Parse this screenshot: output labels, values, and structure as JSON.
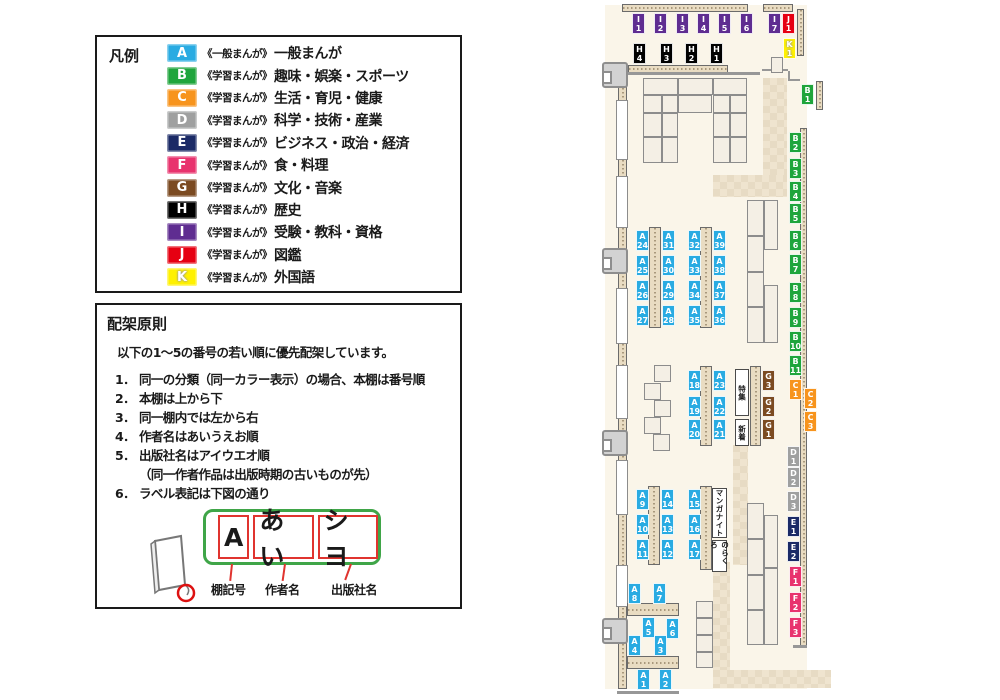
{
  "legend": {
    "title": "凡例",
    "items": [
      {
        "code": "A",
        "color": "#29abe2",
        "prefix": "《一般まんが》",
        "label": "一般まんが"
      },
      {
        "code": "B",
        "color": "#1fa53c",
        "prefix": "《学習まんが》",
        "label": "趣味・娯楽・スポーツ"
      },
      {
        "code": "C",
        "color": "#f7941d",
        "prefix": "《学習まんが》",
        "label": "生活・育児・健康"
      },
      {
        "code": "D",
        "color": "#9fa0a0",
        "prefix": "《学習まんが》",
        "label": "科学・技術・産業"
      },
      {
        "code": "E",
        "color": "#1b2a66",
        "prefix": "《学習まんが》",
        "label": "ビジネス・政治・経済"
      },
      {
        "code": "F",
        "color": "#e8336e",
        "prefix": "《学習まんが》",
        "label": "食・料理"
      },
      {
        "code": "G",
        "color": "#7b4a21",
        "prefix": "《学習まんが》",
        "label": "文化・音楽"
      },
      {
        "code": "H",
        "color": "#000000",
        "prefix": "《学習まんが》",
        "label": "歴史"
      },
      {
        "code": "I",
        "color": "#5f2d91",
        "prefix": "《学習まんが》",
        "label": "受験・教科・資格"
      },
      {
        "code": "J",
        "color": "#e60012",
        "prefix": "《学習まんが》",
        "label": "図鑑"
      },
      {
        "code": "K",
        "color": "#fff100",
        "prefix": "《学習まんが》",
        "label": "外国語"
      }
    ]
  },
  "principles": {
    "title": "配架原則",
    "intro": "以下の1～5の番号の若い順に優先配架しています。",
    "rules": [
      {
        "num": "1．",
        "text": "同一の分類（同一カラー表示）の場合、本棚は番号順"
      },
      {
        "num": "2．",
        "text": "本棚は上から下"
      },
      {
        "num": "3．",
        "text": "同一棚内では左から右"
      },
      {
        "num": "4．",
        "text": "作者名はあいうえお順"
      },
      {
        "num": "5．",
        "text": "出版社名はアイウエオ順",
        "note": "（同一作者作品は出版時期の古いものが先）"
      },
      {
        "num": "6．",
        "text": "ラベル表記は下図の通り"
      }
    ],
    "label_example": {
      "segments": [
        "A",
        "あい",
        "シヨ"
      ],
      "captions": [
        "棚記号",
        "作者名",
        "出版社名"
      ]
    }
  },
  "map": {
    "shelf_labels": [
      {
        "id": "I1",
        "cat": "I",
        "num": "1",
        "x": 632,
        "y": 13
      },
      {
        "id": "I2",
        "cat": "I",
        "num": "2",
        "x": 654,
        "y": 13
      },
      {
        "id": "I3",
        "cat": "I",
        "num": "3",
        "x": 676,
        "y": 13
      },
      {
        "id": "I4",
        "cat": "I",
        "num": "4",
        "x": 697,
        "y": 13
      },
      {
        "id": "I5",
        "cat": "I",
        "num": "5",
        "x": 718,
        "y": 13
      },
      {
        "id": "I6",
        "cat": "I",
        "num": "6",
        "x": 740,
        "y": 13
      },
      {
        "id": "I7",
        "cat": "I",
        "num": "7",
        "x": 768,
        "y": 13
      },
      {
        "id": "J1",
        "cat": "J",
        "num": "1",
        "x": 782,
        "y": 13
      },
      {
        "id": "K1",
        "cat": "K",
        "num": "1",
        "x": 783,
        "y": 38
      },
      {
        "id": "H4",
        "cat": "H",
        "num": "4",
        "x": 633,
        "y": 43
      },
      {
        "id": "H3",
        "cat": "H",
        "num": "3",
        "x": 660,
        "y": 43
      },
      {
        "id": "H2",
        "cat": "H",
        "num": "2",
        "x": 685,
        "y": 43
      },
      {
        "id": "H1",
        "cat": "H",
        "num": "1",
        "x": 710,
        "y": 43
      },
      {
        "id": "B1",
        "cat": "B",
        "num": "1",
        "x": 801,
        "y": 84
      },
      {
        "id": "B2",
        "cat": "B",
        "num": "2",
        "x": 789,
        "y": 132
      },
      {
        "id": "B3",
        "cat": "B",
        "num": "3",
        "x": 789,
        "y": 158
      },
      {
        "id": "B4",
        "cat": "B",
        "num": "4",
        "x": 789,
        "y": 181
      },
      {
        "id": "B5",
        "cat": "B",
        "num": "5",
        "x": 789,
        "y": 203
      },
      {
        "id": "B6",
        "cat": "B",
        "num": "6",
        "x": 789,
        "y": 230
      },
      {
        "id": "B7",
        "cat": "B",
        "num": "7",
        "x": 789,
        "y": 254
      },
      {
        "id": "B8",
        "cat": "B",
        "num": "8",
        "x": 789,
        "y": 282
      },
      {
        "id": "B9",
        "cat": "B",
        "num": "9",
        "x": 789,
        "y": 307
      },
      {
        "id": "B10",
        "cat": "B",
        "num": "10",
        "x": 789,
        "y": 331
      },
      {
        "id": "B11",
        "cat": "B",
        "num": "11",
        "x": 789,
        "y": 355
      },
      {
        "id": "C1",
        "cat": "C",
        "num": "1",
        "x": 789,
        "y": 379
      },
      {
        "id": "C2",
        "cat": "C",
        "num": "2",
        "x": 804,
        "y": 388
      },
      {
        "id": "C3",
        "cat": "C",
        "num": "3",
        "x": 804,
        "y": 411
      },
      {
        "id": "D1",
        "cat": "D",
        "num": "1",
        "x": 787,
        "y": 446
      },
      {
        "id": "D2",
        "cat": "D",
        "num": "2",
        "x": 787,
        "y": 467
      },
      {
        "id": "D3",
        "cat": "D",
        "num": "3",
        "x": 787,
        "y": 491
      },
      {
        "id": "E1",
        "cat": "E",
        "num": "1",
        "x": 787,
        "y": 516
      },
      {
        "id": "E2",
        "cat": "E",
        "num": "2",
        "x": 787,
        "y": 541
      },
      {
        "id": "F1",
        "cat": "F",
        "num": "1",
        "x": 789,
        "y": 566
      },
      {
        "id": "F2",
        "cat": "F",
        "num": "2",
        "x": 789,
        "y": 592
      },
      {
        "id": "F3",
        "cat": "F",
        "num": "3",
        "x": 789,
        "y": 617
      },
      {
        "id": "A24",
        "cat": "A",
        "num": "24",
        "x": 636,
        "y": 230
      },
      {
        "id": "A25",
        "cat": "A",
        "num": "25",
        "x": 636,
        "y": 255
      },
      {
        "id": "A26",
        "cat": "A",
        "num": "26",
        "x": 636,
        "y": 280
      },
      {
        "id": "A27",
        "cat": "A",
        "num": "27",
        "x": 636,
        "y": 305
      },
      {
        "id": "A31",
        "cat": "A",
        "num": "31",
        "x": 662,
        "y": 230
      },
      {
        "id": "A30",
        "cat": "A",
        "num": "30",
        "x": 662,
        "y": 255
      },
      {
        "id": "A29",
        "cat": "A",
        "num": "29",
        "x": 662,
        "y": 280
      },
      {
        "id": "A28",
        "cat": "A",
        "num": "28",
        "x": 662,
        "y": 305
      },
      {
        "id": "A32",
        "cat": "A",
        "num": "32",
        "x": 688,
        "y": 230
      },
      {
        "id": "A33",
        "cat": "A",
        "num": "33",
        "x": 688,
        "y": 255
      },
      {
        "id": "A34",
        "cat": "A",
        "num": "34",
        "x": 688,
        "y": 280
      },
      {
        "id": "A35",
        "cat": "A",
        "num": "35",
        "x": 688,
        "y": 305
      },
      {
        "id": "A39",
        "cat": "A",
        "num": "39",
        "x": 713,
        "y": 230
      },
      {
        "id": "A38",
        "cat": "A",
        "num": "38",
        "x": 713,
        "y": 255
      },
      {
        "id": "A37",
        "cat": "A",
        "num": "37",
        "x": 713,
        "y": 280
      },
      {
        "id": "A36",
        "cat": "A",
        "num": "36",
        "x": 713,
        "y": 305
      },
      {
        "id": "A18",
        "cat": "A",
        "num": "18",
        "x": 688,
        "y": 370
      },
      {
        "id": "A19",
        "cat": "A",
        "num": "19",
        "x": 688,
        "y": 396
      },
      {
        "id": "A20",
        "cat": "A",
        "num": "20",
        "x": 688,
        "y": 419
      },
      {
        "id": "A23",
        "cat": "A",
        "num": "23",
        "x": 713,
        "y": 370
      },
      {
        "id": "A22",
        "cat": "A",
        "num": "22",
        "x": 713,
        "y": 396
      },
      {
        "id": "A21",
        "cat": "A",
        "num": "21",
        "x": 713,
        "y": 419
      },
      {
        "id": "G3",
        "cat": "G",
        "num": "3",
        "x": 762,
        "y": 370
      },
      {
        "id": "G2",
        "cat": "G",
        "num": "2",
        "x": 762,
        "y": 396
      },
      {
        "id": "G1",
        "cat": "G",
        "num": "1",
        "x": 762,
        "y": 419
      },
      {
        "id": "A9",
        "cat": "A",
        "num": "9",
        "x": 636,
        "y": 489
      },
      {
        "id": "A10",
        "cat": "A",
        "num": "10",
        "x": 636,
        "y": 514
      },
      {
        "id": "A11",
        "cat": "A",
        "num": "11",
        "x": 636,
        "y": 539
      },
      {
        "id": "A14",
        "cat": "A",
        "num": "14",
        "x": 661,
        "y": 489
      },
      {
        "id": "A13",
        "cat": "A",
        "num": "13",
        "x": 661,
        "y": 514
      },
      {
        "id": "A12",
        "cat": "A",
        "num": "12",
        "x": 661,
        "y": 539
      },
      {
        "id": "A15",
        "cat": "A",
        "num": "15",
        "x": 688,
        "y": 489
      },
      {
        "id": "A16",
        "cat": "A",
        "num": "16",
        "x": 688,
        "y": 514
      },
      {
        "id": "A17",
        "cat": "A",
        "num": "17",
        "x": 688,
        "y": 539
      },
      {
        "id": "A8",
        "cat": "A",
        "num": "8",
        "x": 628,
        "y": 583
      },
      {
        "id": "A7",
        "cat": "A",
        "num": "7",
        "x": 653,
        "y": 583
      },
      {
        "id": "A5",
        "cat": "A",
        "num": "5",
        "x": 642,
        "y": 617
      },
      {
        "id": "A6",
        "cat": "A",
        "num": "6",
        "x": 666,
        "y": 618
      },
      {
        "id": "A4",
        "cat": "A",
        "num": "4",
        "x": 628,
        "y": 635
      },
      {
        "id": "A3",
        "cat": "A",
        "num": "3",
        "x": 654,
        "y": 635
      },
      {
        "id": "A1",
        "cat": "A",
        "num": "1",
        "x": 637,
        "y": 669
      },
      {
        "id": "A2",
        "cat": "A",
        "num": "2",
        "x": 659,
        "y": 669
      }
    ],
    "area_labels": [
      {
        "text": "特集",
        "x": 735,
        "y": 369,
        "w": 14,
        "h": 47
      },
      {
        "text": "新着",
        "x": 735,
        "y": 419,
        "w": 14,
        "h": 27
      },
      {
        "text": "マンガナイト",
        "x": 712,
        "y": 488,
        "w": 15,
        "h": 50
      },
      {
        "text": "のらくろ",
        "x": 712,
        "y": 540,
        "w": 15,
        "h": 32
      }
    ]
  }
}
